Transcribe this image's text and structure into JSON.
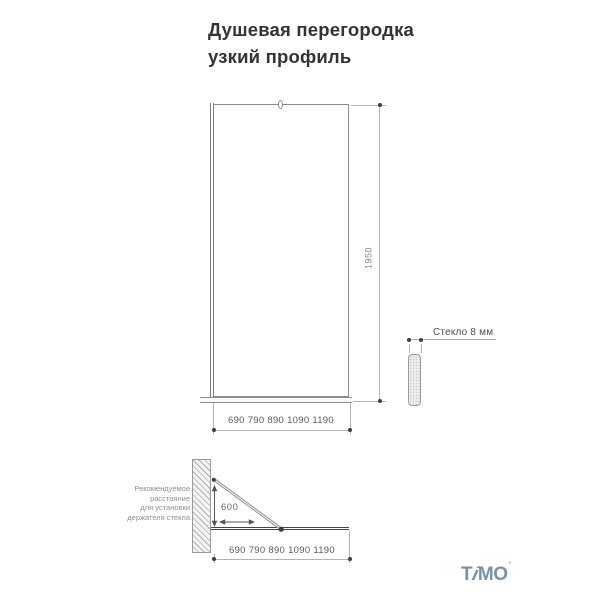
{
  "title": {
    "line1": "Душевая перегородка",
    "line2": "узкий профиль"
  },
  "front_view": {
    "height_label": "1950",
    "width_label": "690 790 890 1090 1190",
    "height_mm": 1950,
    "width_options_mm": [
      690,
      790,
      890,
      1090,
      1190
    ]
  },
  "side_view": {
    "glass_label": "Стекло 8 мм",
    "glass_thickness_mm": 8
  },
  "top_view": {
    "distance_label": "600",
    "distance_mm": 600,
    "note_lines": [
      "Рекомендуемое",
      "расстояние",
      "для установки",
      "держателя стекла"
    ],
    "width_label": "690 790 890 1090 1190"
  },
  "logo": {
    "t": "T",
    "i": "i",
    "mo": "MO",
    "mark": "°"
  },
  "colors": {
    "background": "#ffffff",
    "title_text": "#333333",
    "drawing_line": "#8d8d8d",
    "dim_line": "#b3b3b3",
    "dim_dot": "#3f3f3f",
    "dim_text": "#5a5a5a",
    "note_text": "#8f8f8f",
    "glass_plan_line": "#454545",
    "logo_blue": "#7b91a7"
  }
}
